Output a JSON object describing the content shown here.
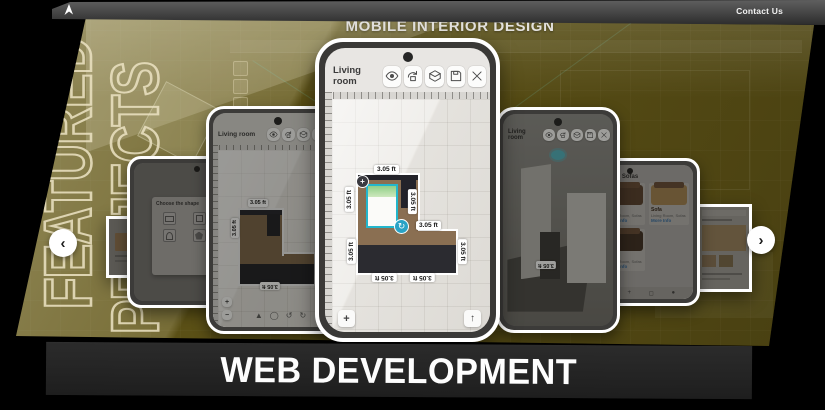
{
  "window": {
    "contact_label": "Contact Us"
  },
  "hero": {
    "title": "MOBILE INTERIOR DESIGN",
    "featured_line1": "FEATURED",
    "featured_line2": "PROJECTS",
    "bg_color": "#5e5317"
  },
  "banner": {
    "label": "WEB DEVELOPMENT",
    "bg_color": "#242424"
  },
  "carousel": {
    "prev_label": "‹",
    "next_label": "›",
    "phone_editor": {
      "room_label": "Living room",
      "toolbar_icons": [
        "visibility-icon",
        "rotate-3d-icon",
        "view-3d-icon",
        "save-icon",
        "close-icon"
      ],
      "measure_label": "3.05 ft",
      "zoom_in_label": "+",
      "zoom_out_label": "−",
      "scroll_up_label": "↑",
      "scroll_down_label": "↓",
      "selection_color": "#23b6cc"
    },
    "editor_icons": {
      "select": "▲",
      "shape": "◯",
      "undo": "↺",
      "redo": "↻"
    },
    "phone_shapes": {
      "dialog_title": "Choose the shape",
      "close_label": "×"
    },
    "phone_catalog": {
      "title": "Sofas",
      "card_title": "Sofa",
      "card_subtitle": "Living Room, Sofas",
      "card_link": "More Info",
      "nav_icons": {
        "home": "⌂",
        "menu": "≡",
        "add": "+",
        "grid": "◻",
        "profile": "●"
      }
    }
  }
}
